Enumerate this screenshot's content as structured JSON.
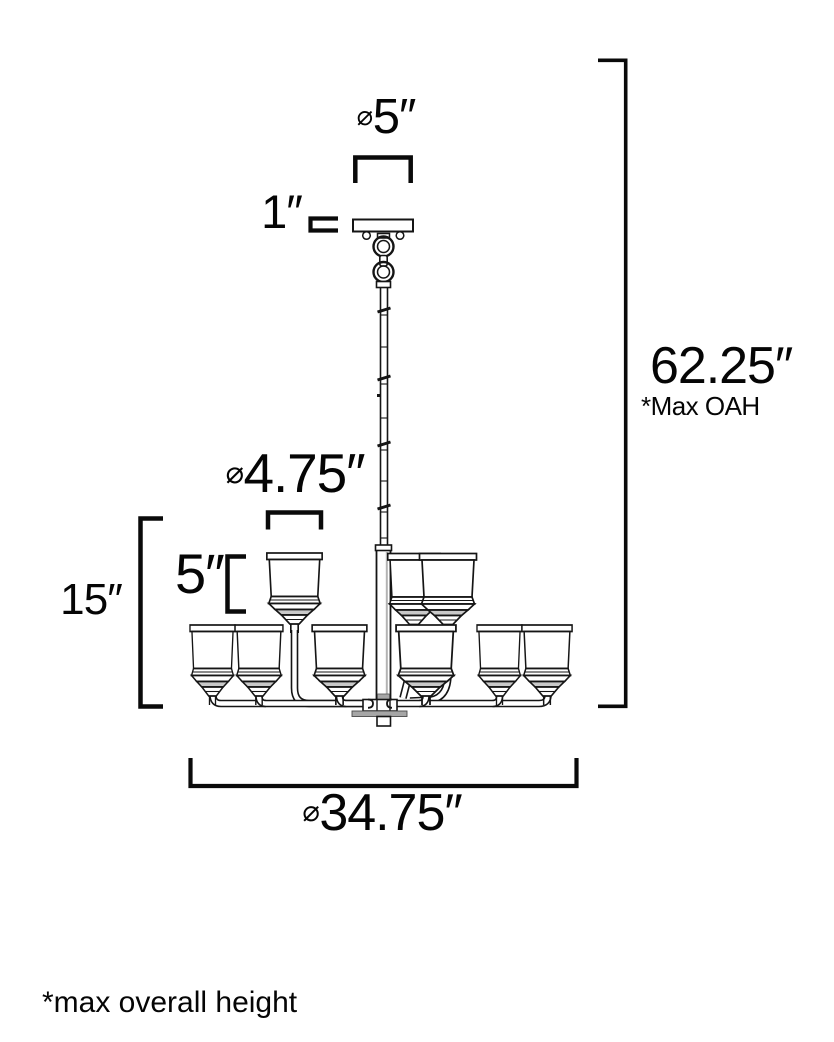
{
  "dimensions": {
    "canopy_diameter": {
      "symbol": "⌀",
      "value": "5″"
    },
    "canopy_height": {
      "value": "1″"
    },
    "shade_diameter": {
      "symbol": "⌀",
      "value": "4.75″"
    },
    "shade_height": {
      "value": "5″"
    },
    "body_height": {
      "value": "15″"
    },
    "max_overall_height": {
      "value": "62.25″",
      "note": "*Max OAH"
    },
    "fixture_diameter": {
      "symbol": "⌀",
      "value": "34.75″"
    }
  },
  "footnote": "*max overall height",
  "colors": {
    "line": "#0f0f0f",
    "shade_fill": "#ffffff",
    "gray_accent": "#a6a6a6",
    "ring_gray": "#c9c9c9"
  }
}
